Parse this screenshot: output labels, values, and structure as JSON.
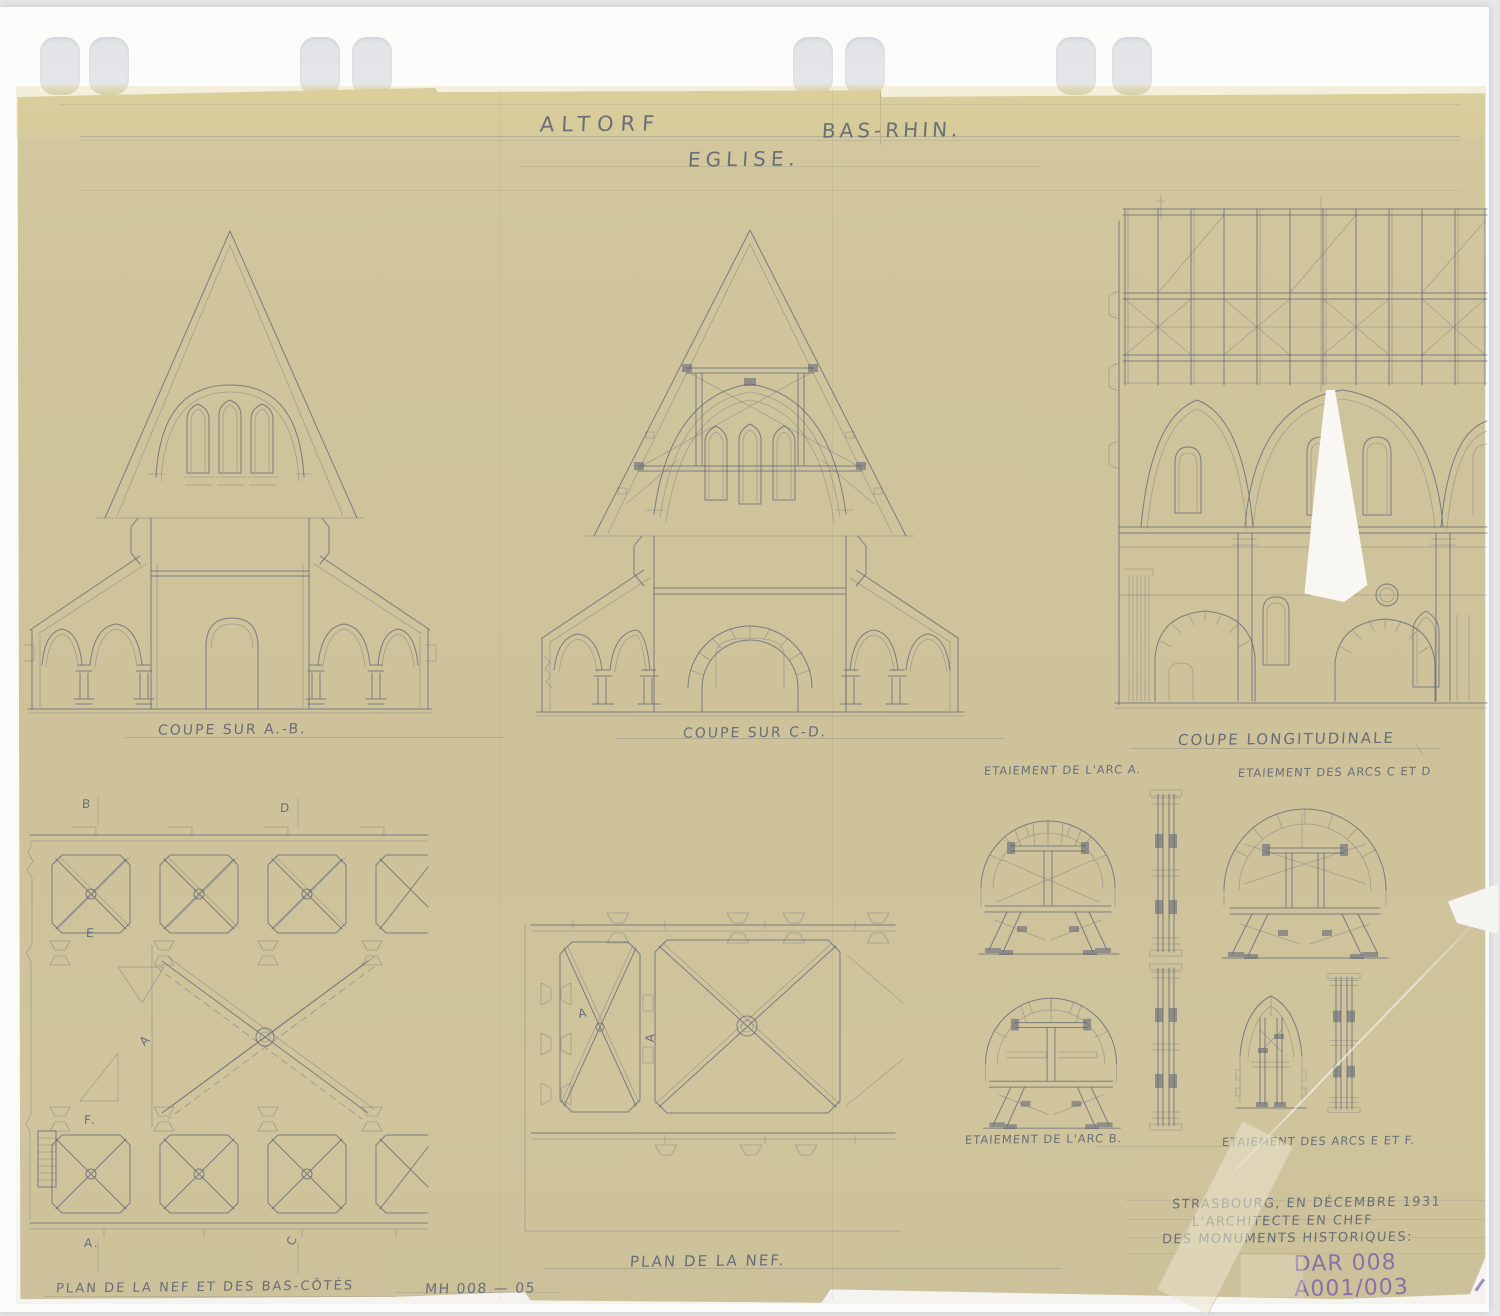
{
  "header": {
    "place": "ALTORF",
    "department": "BAS-RHIN.",
    "building": "EGLISE."
  },
  "sections": {
    "coupe_ab": "COUPE SUR A.-B.",
    "coupe_cd": "COUPE SUR C-D.",
    "coupe_longitudinale": "COUPE LONGITUDINALE",
    "etaiement_arc_a": "ETAIEMENT DE L'ARC A.",
    "etaiement_arcs_cd": "ETAIEMENT DES ARCS C ET D",
    "etaiement_arc_b": "ETAIEMENT DE L'ARC B.",
    "etaiement_arcs_ef": "ETAIEMENT DES ARCS E ET F.",
    "plan_nef": "PLAN DE LA NEF.",
    "plan_nef_bas_cotes": "PLAN DE LA NEF ET DES BAS-CÔTÉS"
  },
  "plan_markers": {
    "left": [
      "B",
      "D",
      "E",
      "A",
      "F.",
      "A.",
      "C"
    ],
    "center": [
      "A",
      "A"
    ]
  },
  "signature": {
    "line1": "STRASBOURG, EN DÉCEMBRE 1931",
    "line2": "L'ARCHITECTE EN CHEF",
    "line3": "DES MONUMENTS HISTORIQUES:"
  },
  "references": {
    "archive": "DAR 008 A001/003",
    "mh": "MH 008 — 05"
  },
  "colors": {
    "paper": "#cfc49c",
    "backing": "#fbfbfa",
    "scanner_bg": "#e7e7e9",
    "pencil": "#5c6374",
    "stamp_purple": "#7e63ac"
  }
}
